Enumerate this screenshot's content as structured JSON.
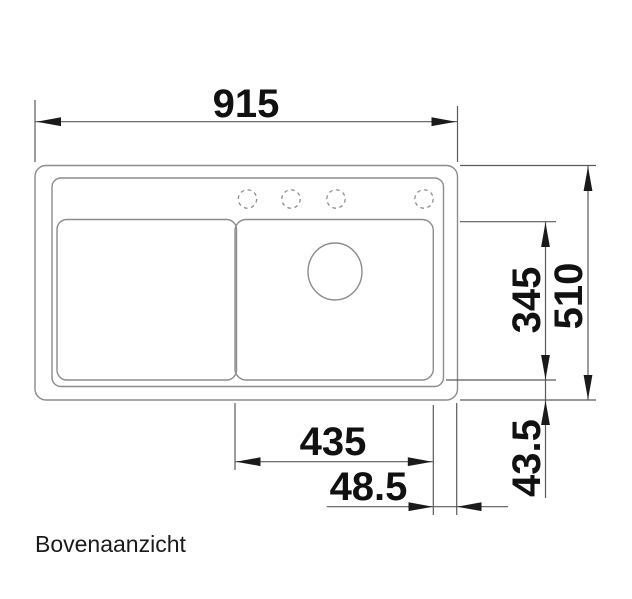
{
  "caption": "Bovenaanzicht",
  "dimensions": {
    "overall_width": "915",
    "overall_depth": "510",
    "bowl_depth": "345",
    "bowl_width": "435",
    "right_ledge_offset": "48.5",
    "rear_ledge_offset": "43.5"
  },
  "features": {
    "bowls": 2,
    "tap_holes": 4,
    "drain_holes": 1
  },
  "colors": {
    "background": "#ffffff",
    "sink_outline": "#8c8c8c",
    "dimension_line": "#5a5a5a",
    "dimension_text": "#111111"
  }
}
